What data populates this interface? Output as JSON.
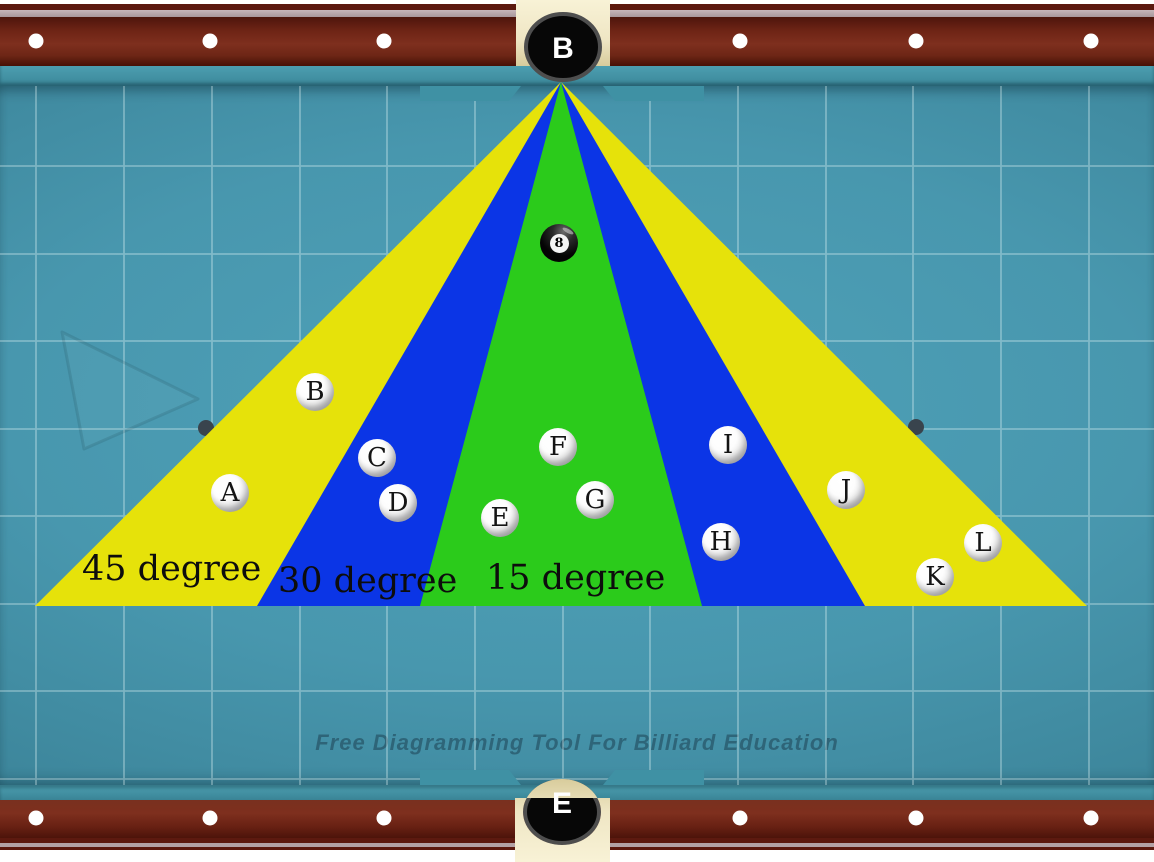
{
  "title": "Billiard cut-angle zones diagram",
  "watermark": "Free Diagramming Tool For Billiard Education",
  "pockets": [
    {
      "label": "B"
    },
    {
      "label": "E"
    }
  ],
  "zones": [
    {
      "label": "45 degree",
      "color": "#e6e20a"
    },
    {
      "label": "30 degree",
      "color": "#0b35e6"
    },
    {
      "label": "15 degree",
      "color": "#2bcb1b"
    }
  ],
  "eight_ball": {
    "number": "8"
  },
  "balls": [
    {
      "label": "A",
      "x": 230,
      "y": 493
    },
    {
      "label": "B",
      "x": 315,
      "y": 392
    },
    {
      "label": "C",
      "x": 377,
      "y": 458
    },
    {
      "label": "D",
      "x": 398,
      "y": 503
    },
    {
      "label": "E",
      "x": 500,
      "y": 518
    },
    {
      "label": "F",
      "x": 558,
      "y": 447
    },
    {
      "label": "G",
      "x": 595,
      "y": 500
    },
    {
      "label": "H",
      "x": 721,
      "y": 542
    },
    {
      "label": "I",
      "x": 728,
      "y": 445
    },
    {
      "label": "J",
      "x": 846,
      "y": 490
    },
    {
      "label": "K",
      "x": 935,
      "y": 577
    },
    {
      "label": "L",
      "x": 983,
      "y": 543
    }
  ],
  "colors": {
    "cloth": "#4897ae",
    "cushion": "#4293a6",
    "rail_wood": "#7b2d1c",
    "rail_accent": "#b3a2a6",
    "pocket_liner": "#efe6c4",
    "pocket_hole": "#070707",
    "grid_line": "#e9f8fa",
    "spot": "#39444d"
  }
}
